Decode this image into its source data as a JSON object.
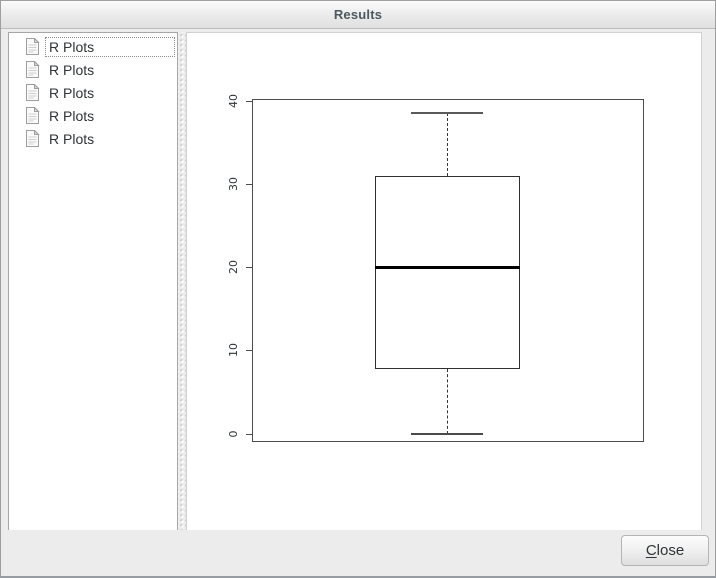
{
  "window": {
    "title": "Results"
  },
  "sidebar": {
    "items": [
      {
        "label": "R Plots",
        "selected": true
      },
      {
        "label": "R Plots",
        "selected": false
      },
      {
        "label": "R Plots",
        "selected": false
      },
      {
        "label": "R Plots",
        "selected": false
      },
      {
        "label": "R Plots",
        "selected": false
      }
    ]
  },
  "footer": {
    "close_mnemonic": "C",
    "close_rest": "lose"
  },
  "chart_data": {
    "type": "boxplot",
    "title": "",
    "xlabel": "",
    "ylabel": "",
    "orientation": "vertical",
    "grid": false,
    "yticks": [
      0,
      10,
      20,
      30,
      40
    ],
    "ylim": [
      -1,
      40.2
    ],
    "series": [
      {
        "name": "boxplot-1",
        "min": 0,
        "q1": 7.75,
        "median": 20,
        "q3": 31,
        "max": 38.5
      }
    ]
  },
  "colors": {
    "titlebar_text": "#4c5861",
    "plot_frame": "#4d4d4d",
    "box_border": "#2f2f2f",
    "median_line": "#000000",
    "whisker": "#333333",
    "panel_background": "#ffffff",
    "dialog_background": "#ececec"
  }
}
